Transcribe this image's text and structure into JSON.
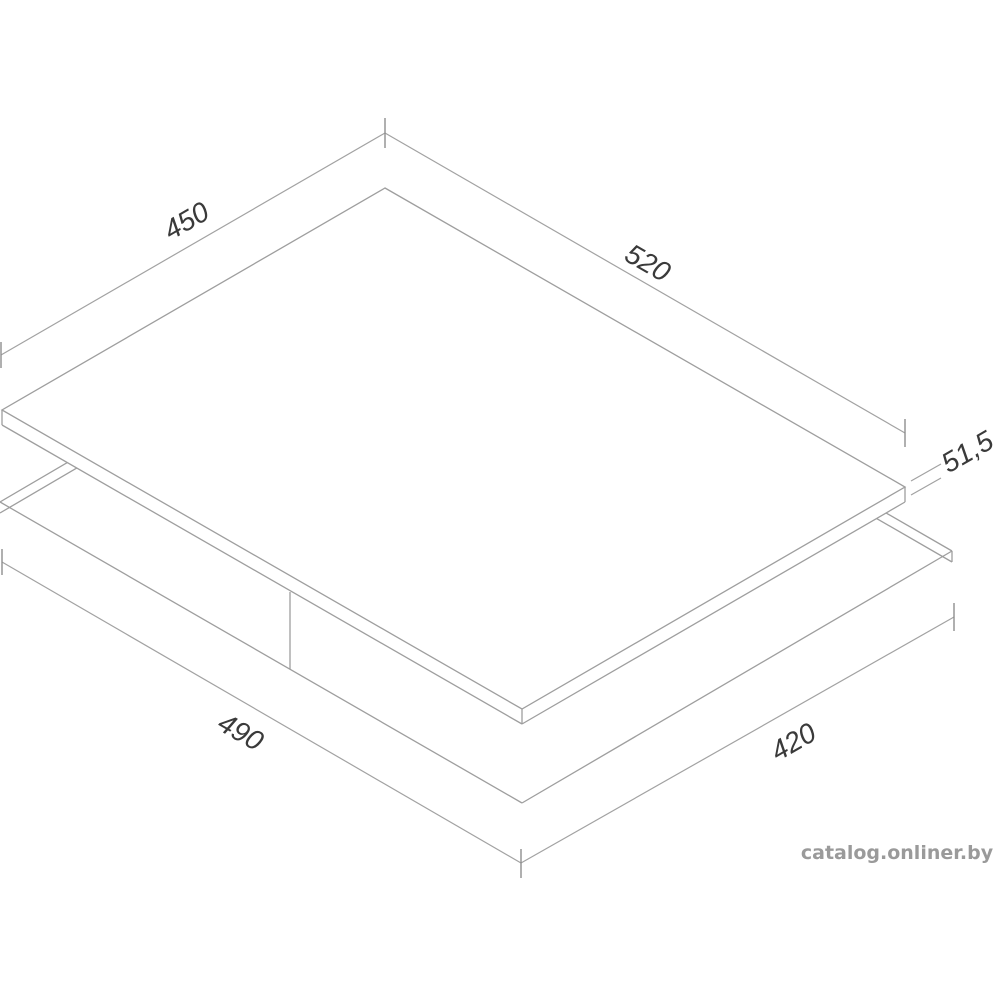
{
  "diagram": {
    "type": "isometric-technical-drawing",
    "subject": "built-in hob top panel and worktop cutout dimensions",
    "background_color": "#ffffff",
    "line_color": "#9e9e9e",
    "label_color": "#3a3a3a",
    "dimensions": {
      "panel_width": "450",
      "panel_depth": "520",
      "panel_height": "51,5",
      "cutout_width": "490",
      "cutout_depth": "420"
    }
  },
  "watermark": {
    "text": "catalog.onliner.by",
    "color": "#9a9a9a"
  }
}
